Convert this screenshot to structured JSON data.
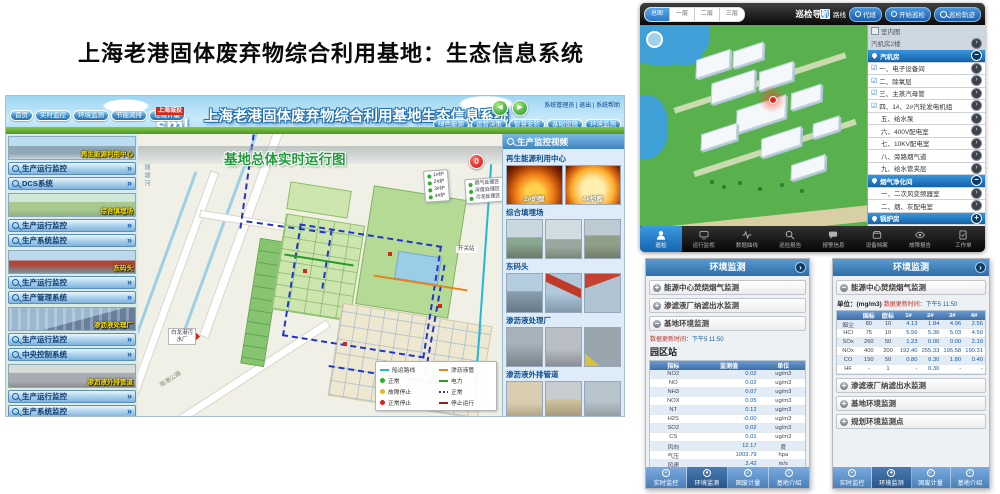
{
  "page_title": "上海老港固体废弃物综合利用基地：生态信息系统",
  "colors": {
    "accent_blue": "#2e6da8",
    "alert_red": "#d01010",
    "active_tab_blue": "#2a78c8",
    "map_title_green": "#1f9b3a",
    "section_label_yellow": "#ffe200"
  },
  "desktop": {
    "nav_left": [
      "首页",
      "实时监控",
      "环境监测",
      "节能减排",
      "垃圾计量"
    ],
    "logo": {
      "company": "上海城投",
      "abbr": "sml"
    },
    "header_title": "上海老港固体废弃物综合利用基地生态信息系统",
    "user_links": "系统管理员 | 退出 | 系统帮助",
    "nav_right": [
      "绿色能源",
      "运营决策",
      "智慧安防",
      "基础设施",
      "环境监测"
    ],
    "sidebar": [
      {
        "label": "再生能源利用中心",
        "buttons": [
          "生产运行监控",
          "DCS系统"
        ]
      },
      {
        "label": "综合填埋场",
        "buttons": [
          "生产运行监控",
          "生产系统监控"
        ]
      },
      {
        "label": "东码头",
        "buttons": [
          "生产运行监控",
          "生产管理系统"
        ]
      },
      {
        "label": "渗沥液处理厂",
        "buttons": [
          "生产运行监控",
          "中央控制系统"
        ]
      },
      {
        "label": "渗沥液外排管道",
        "buttons": [
          "生产运行监控",
          "生产系统监控"
        ]
      }
    ],
    "map": {
      "title": "基地总体实时运行图",
      "alert_count": "0",
      "boilers": [
        "1#炉",
        "2#炉",
        "3#炉",
        "4#炉"
      ],
      "zones": [
        "烟气处理区",
        "深度处理区",
        "污泥处理区"
      ],
      "labels": {
        "river": "随塘河",
        "road": "南港公路",
        "plant": "白龙港污水厂",
        "switch_station": "开关站"
      },
      "legend": [
        {
          "swatch": "sw-cyan",
          "label": "船运路线"
        },
        {
          "swatch": "sw-orange",
          "label": "渗沥液管"
        },
        {
          "swatch": "sw-dot-green",
          "label": "正常"
        },
        {
          "swatch": "sw-green",
          "label": "电力"
        },
        {
          "swatch": "sw-dot-yellow",
          "label": "故障停止"
        },
        {
          "swatch": "sw-dash-blue",
          "label": "正常"
        },
        {
          "swatch": "sw-dot-red",
          "label": "正常停止"
        },
        {
          "swatch": "sw-dark",
          "label": "停止运行"
        }
      ]
    },
    "cameras": {
      "title": "生产监控视频",
      "groups": [
        {
          "name": "再生能源利用中心",
          "thumbs": [
            "2#炉膛",
            "4#炉膛"
          ]
        },
        {
          "name": "综合填埋场"
        },
        {
          "name": "东码头"
        },
        {
          "name": "渗沥液处理厂"
        },
        {
          "name": "渗沥液外排管道"
        }
      ]
    }
  },
  "mobile": {
    "topbar": {
      "segments": [
        "总图",
        "一层",
        "二层",
        "三层"
      ],
      "title": "巡检导航",
      "checkbox_label": "路线",
      "buttons": [
        "代班",
        "开始巡检",
        "巡检轨迹"
      ]
    },
    "list": [
      {
        "label": "室内图"
      },
      {
        "label": "汽机房2楼"
      },
      {
        "label": "汽机房"
      },
      {
        "label": "一、电子设备间"
      },
      {
        "label": "二、除氧层"
      },
      {
        "label": "三、主蒸汽母管"
      },
      {
        "label": "四、1#、2#汽轮发电机组"
      },
      {
        "label": "五、给水泵"
      },
      {
        "label": "六、400V配电室"
      },
      {
        "label": "七、10KV配电室"
      },
      {
        "label": "八、旁路烟气道"
      },
      {
        "label": "九、给水管夹层"
      },
      {
        "label": "烟气净化间"
      },
      {
        "label": "一、二次风变频器室"
      },
      {
        "label": "二、烟、灰配电室"
      },
      {
        "label": "锅炉房"
      }
    ],
    "tabs": [
      "巡检",
      "运行监视",
      "数据曲线",
      "巡检报告",
      "报警信息",
      "设备档案",
      "故障报告",
      "工作单"
    ]
  },
  "env": {
    "title": "环境监测",
    "update_label": "数据更新时间：",
    "update_time": "下午5 11:50",
    "tabs": [
      "实时监控",
      "环境监测",
      "固废计量",
      "基地介绍"
    ],
    "left": {
      "accordion": [
        "能源中心焚烧烟气监测",
        "渗滤液厂纳滤出水监测",
        "基地环境监测"
      ],
      "station": "园区站",
      "station2": "西边站",
      "table": {
        "headers": [
          "指标",
          "监测值",
          "单位"
        ],
        "rows": [
          [
            "NO2",
            "0.02",
            "ug/m3"
          ],
          [
            "NO",
            "0.02",
            "ug/m3"
          ],
          [
            "NH3",
            "0.07",
            "ug/m3"
          ],
          [
            "NOX",
            "0.05",
            "ug/m3"
          ],
          [
            "NT",
            "0.12",
            "ug/m3"
          ],
          [
            "H2S",
            "-0.00",
            "ug/m3"
          ],
          [
            "SO2",
            "0.02",
            "ug/m3"
          ],
          [
            "CS",
            "0.01",
            "ug/m3"
          ],
          [
            "风向",
            "12.17",
            "度"
          ],
          [
            "气压",
            "1003.79",
            "hpa"
          ],
          [
            "风速",
            "3.42",
            "m/s"
          ],
          [
            "温度",
            "24.83",
            "℃"
          ],
          [
            "湿度",
            "88.36",
            "%"
          ]
        ]
      }
    },
    "right": {
      "expanded": "能源中心焚烧烟气监测",
      "unit_label": "单位：(mg/m3)",
      "collapsed": [
        "渗滤液厂纳滤出水监测",
        "基地环境监测",
        "规划环境监测点"
      ],
      "table": {
        "headers": [
          "",
          "国标",
          "欧标",
          "1#",
          "2#",
          "3#",
          "4#"
        ],
        "rows": [
          [
            "烟尘",
            "80",
            "10",
            "4.13",
            "1.84",
            "4.96",
            "2.56"
          ],
          [
            "HCl",
            "75",
            "10",
            "5.56",
            "5.36",
            "5.03",
            "4.50"
          ],
          [
            "SOx",
            "260",
            "50",
            "1.23",
            "0.00",
            "0.00",
            "2.10"
          ],
          [
            "NOx",
            "400",
            "200",
            "192.40",
            "255.33",
            "195.58",
            "190.31"
          ],
          [
            "CO",
            "150",
            "50",
            "0.80",
            "0.30",
            "1.80",
            "0.40"
          ],
          [
            "HF",
            "-",
            "1",
            "-",
            "0.30",
            "-",
            "-"
          ]
        ]
      }
    }
  }
}
